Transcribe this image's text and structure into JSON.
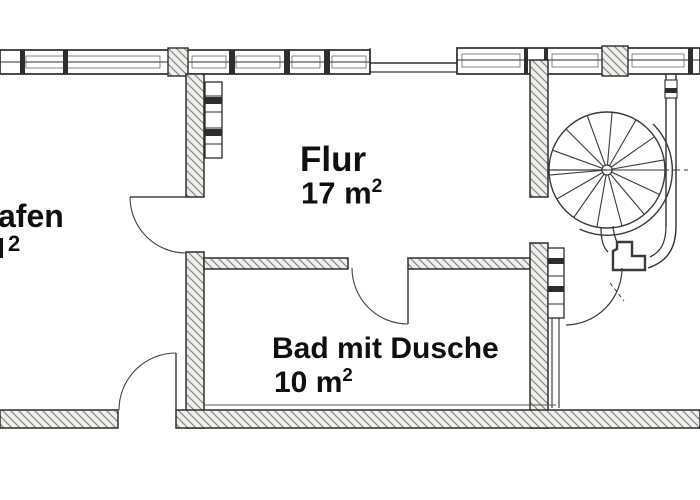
{
  "plan": {
    "kind": "floor-plan",
    "features": [
      "spiral-staircase",
      "door-swings",
      "window-band-walls",
      "hatched-masonry-walls",
      "wall-shelf-symbols"
    ],
    "colors": {
      "line": "#2d2d2d",
      "hatch": "#8a8a8a",
      "wall_fill": "#efefec",
      "background": "#ffffff",
      "text": "#0f0f0f"
    }
  },
  "rooms": [
    {
      "id": "room-left-cutoff",
      "label": "afen",
      "area_value": "",
      "area_sup": "2"
    },
    {
      "id": "flur",
      "label": "Flur",
      "area_value": "17 m",
      "area_sup": "2"
    },
    {
      "id": "bad",
      "label": "Bad mit Dusche",
      "area_value": "10 m",
      "area_sup": "2"
    }
  ]
}
